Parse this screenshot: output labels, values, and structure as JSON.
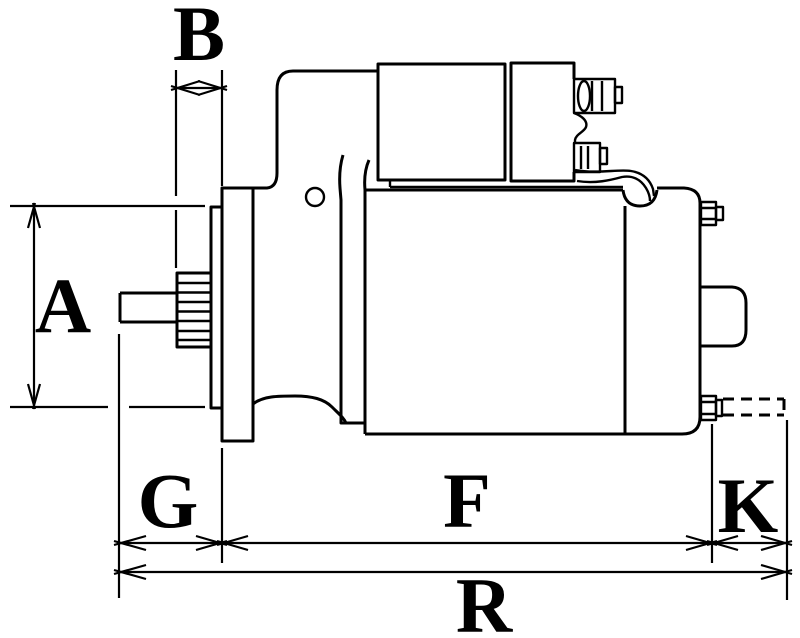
{
  "diagram": {
    "type": "technical-dimension-drawing",
    "subject": "starter motor side view",
    "background_color": "#ffffff",
    "line_color": "#000000",
    "dimension_labels": {
      "A": "A",
      "B": "B",
      "G": "G",
      "F": "F",
      "K": "K",
      "R": "R"
    },
    "dimensions": [
      {
        "label": "A",
        "orientation": "vertical"
      },
      {
        "label": "B",
        "orientation": "horizontal"
      },
      {
        "label": "G",
        "orientation": "horizontal"
      },
      {
        "label": "F",
        "orientation": "horizontal"
      },
      {
        "label": "K",
        "orientation": "horizontal"
      },
      {
        "label": "R",
        "orientation": "horizontal"
      }
    ]
  }
}
